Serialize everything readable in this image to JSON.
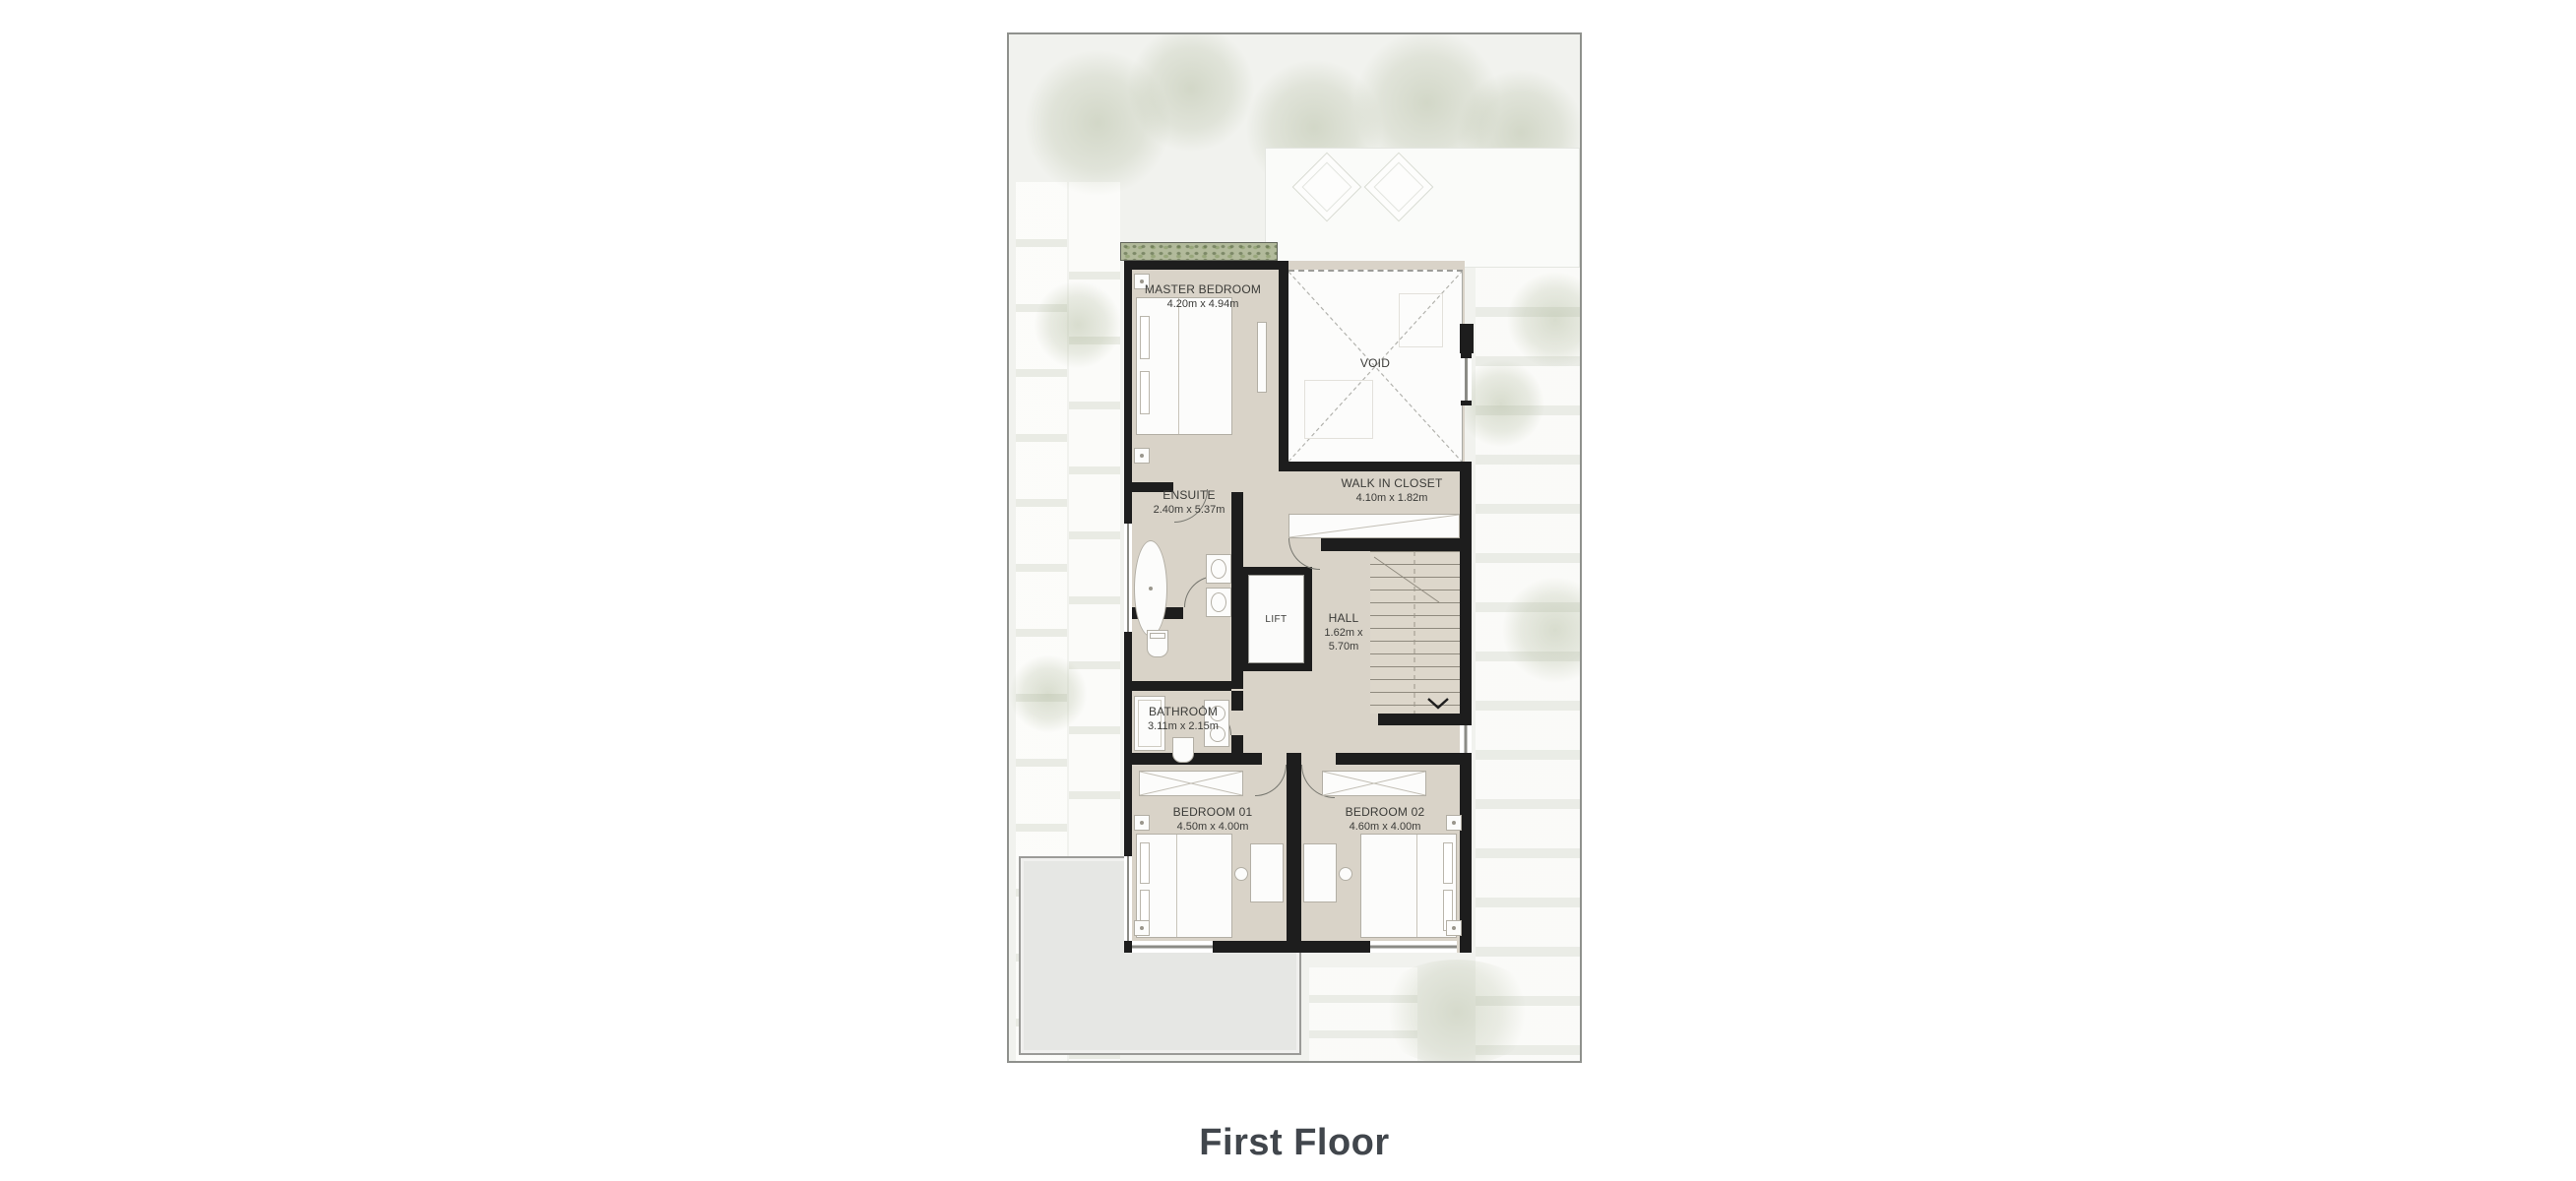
{
  "title": "First Floor",
  "colors": {
    "wall": "#1d1d1d",
    "floor": "#d9d3c8",
    "plot_background": "#f1f2ee",
    "terrace": "#e6e7e4",
    "planter_green": "#b2ba9b",
    "title_text": "#41464c",
    "label_text": "#3b3b38"
  },
  "rooms": {
    "master_bedroom": {
      "name": "MASTER BEDROOM",
      "dims": "4.20m x 4.94m"
    },
    "void": {
      "name": "VOID"
    },
    "walk_in_closet": {
      "name": "WALK IN CLOSET",
      "dims": "4.10m x 1.82m"
    },
    "ensuite": {
      "name": "ENSUITE",
      "dims": "2.40m x 5.37m"
    },
    "lift": {
      "name": "LIFT"
    },
    "hall": {
      "name": "HALL",
      "dims": "1.62m x 5.70m"
    },
    "bathroom": {
      "name": "BATHROOM",
      "dims": "3.11m x 2.15m"
    },
    "bedroom_01": {
      "name": "BEDROOM 01",
      "dims": "4.50m x 4.00m"
    },
    "bedroom_02": {
      "name": "BEDROOM 02",
      "dims": "4.60m x 4.00m"
    }
  }
}
